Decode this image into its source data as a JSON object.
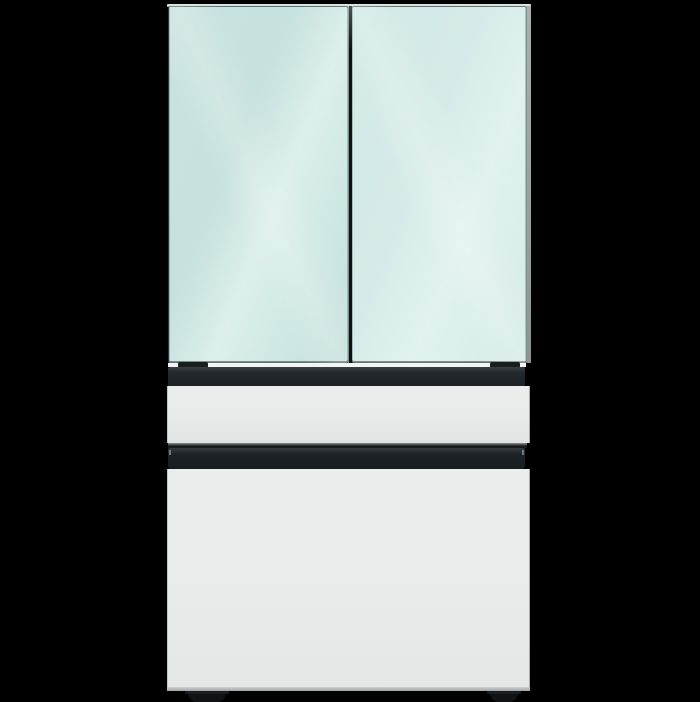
{
  "scene": {
    "description": "Studio product photo on a black background of a four-door French-door refrigerator: two pale morning-blue glass upper doors, a white middle drawer, a long black handle bar, a large white bottom drawer, black trim bands and two small black feet."
  },
  "product": {
    "type": "4-door French door refrigerator",
    "upper_doors_finish": "pale morning-blue glossy glass",
    "lower_panels_finish": "white glossy panels",
    "trim_finish": "matte black"
  },
  "parts": [
    "cabinet-top-edge",
    "upper-left-door",
    "upper-right-door",
    "door-gap",
    "door-bottom-trim-band",
    "middle-drawer",
    "drawer-divider",
    "bottom-drawer-handle-bar",
    "bottom-drawer",
    "left-foot",
    "right-foot"
  ],
  "colors": {
    "background": "#000000",
    "cabinet_top": "#ccd1d0",
    "side_strip": "#aab0af",
    "door_left_base": "#c9e3e0",
    "door_left_hi": "#dcefec",
    "door_right_base": "#d6ebe9",
    "door_right_hi": "#e1f2f0",
    "door_edge_dark": "#2d393c",
    "gap_dark": "#0d1214",
    "trim_band": "#23282d",
    "handle_bar": "#1d2227",
    "divider_dark": "#171b1d",
    "drawer_face": "#e9ebeb",
    "drawer_face_low": "#e2e4e4",
    "drawer_edge": "#a7acac",
    "foot": "#101316"
  }
}
